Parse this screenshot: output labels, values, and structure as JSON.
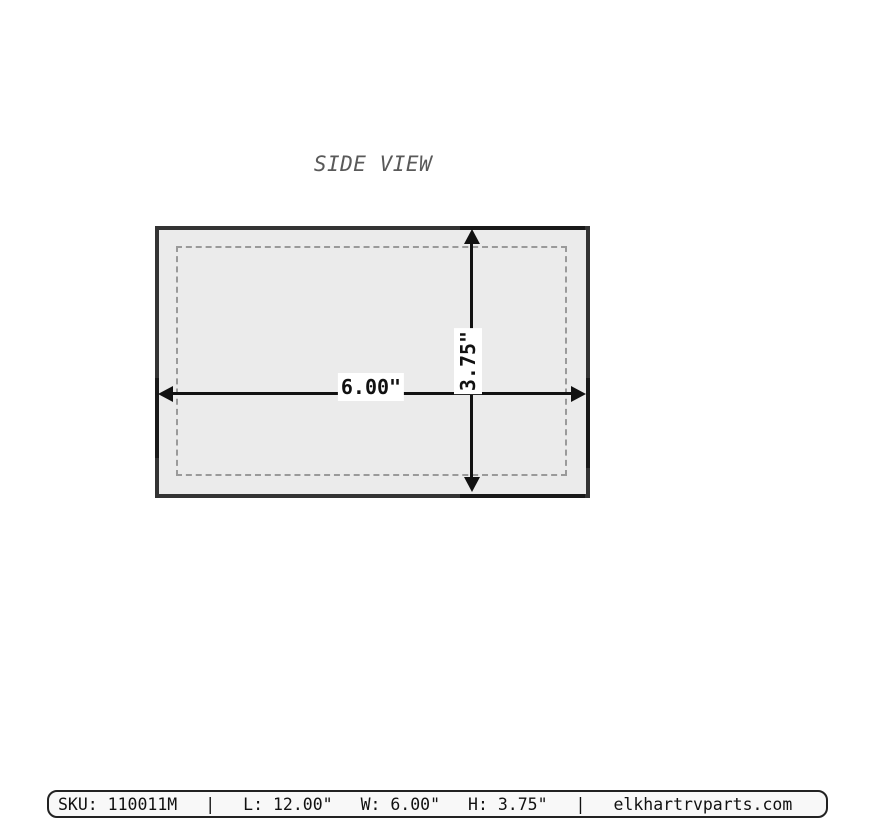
{
  "title": "SIDE VIEW",
  "diagram": {
    "width_label": "6.00\"",
    "height_label": "3.75\""
  },
  "footer": {
    "sku": "SKU: 110011M",
    "separator": "|",
    "length": "L: 12.00\"",
    "width": "W: 6.00\"",
    "height": "H: 3.75\"",
    "website": "elkhartrvparts.com"
  },
  "colors": {
    "background": "#ffffff",
    "part_fill": "#ebebeb",
    "part_outline": "#333333",
    "outline_accent": "#191919",
    "dashed_inner": "#9a9a9a",
    "dimension_arrow": "#111111",
    "title_text": "#595959",
    "footer_background": "#f8f8f8",
    "footer_border": "#222222",
    "footer_text": "#111111"
  }
}
